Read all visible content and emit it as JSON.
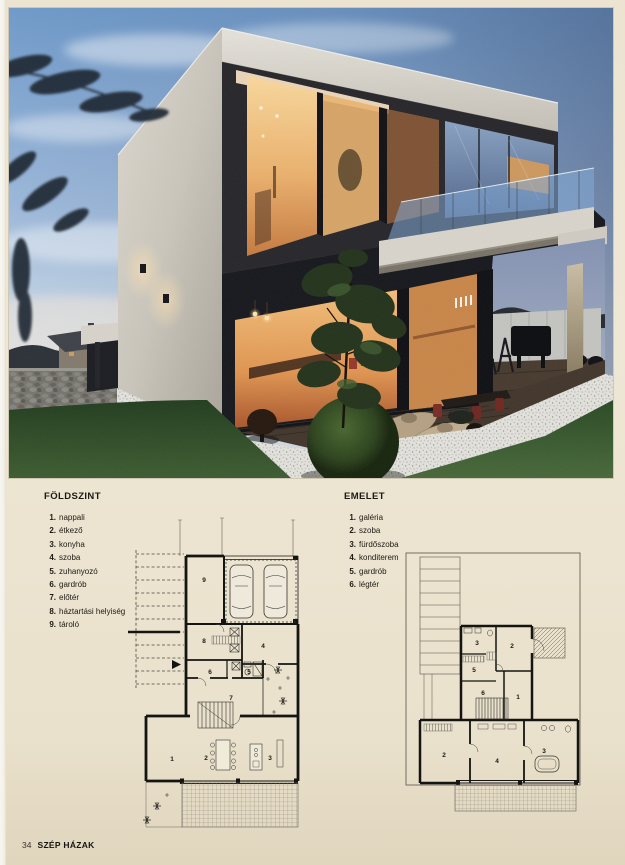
{
  "page": {
    "background": "#ece4d1",
    "footer": {
      "page_number": "34",
      "magazine": "SZÉP HÁZAK"
    }
  },
  "photo": {
    "colors": {
      "sky_top": "#6f9aca",
      "sky_horizon": "#e6ebf0",
      "dusk_right": "#2f3c5e",
      "wall_light": "#d6d2c9",
      "interior_glow": "#f0b067",
      "glass_blue": "#7e97b8",
      "lawn": "#2c4a26",
      "gravel": "#e2e1dc"
    }
  },
  "legends": {
    "ground": {
      "title": "FÖLDSZINT",
      "items": [
        {
          "n": "1.",
          "label": "nappali"
        },
        {
          "n": "2.",
          "label": "étkező"
        },
        {
          "n": "3.",
          "label": "konyha"
        },
        {
          "n": "4.",
          "label": "szoba"
        },
        {
          "n": "5.",
          "label": "zuhanyozó"
        },
        {
          "n": "6.",
          "label": "gardrób"
        },
        {
          "n": "7.",
          "label": "előtér"
        },
        {
          "n": "8.",
          "label": "háztartási helyiség"
        },
        {
          "n": "9.",
          "label": "tároló"
        }
      ]
    },
    "upper": {
      "title": "EMELET",
      "items": [
        {
          "n": "1.",
          "label": "galéria"
        },
        {
          "n": "2.",
          "label": "szoba"
        },
        {
          "n": "3.",
          "label": "fürdőszoba"
        },
        {
          "n": "4.",
          "label": "konditerem"
        },
        {
          "n": "5.",
          "label": "gardrób"
        },
        {
          "n": "6.",
          "label": "légtér"
        }
      ]
    }
  },
  "plans": {
    "ground": {
      "labels": [
        "1",
        "2",
        "3",
        "4",
        "5",
        "6",
        "7",
        "8",
        "9"
      ]
    },
    "upper": {
      "labels": [
        "1",
        "2",
        "2",
        "3",
        "3",
        "4",
        "5",
        "6"
      ]
    }
  }
}
